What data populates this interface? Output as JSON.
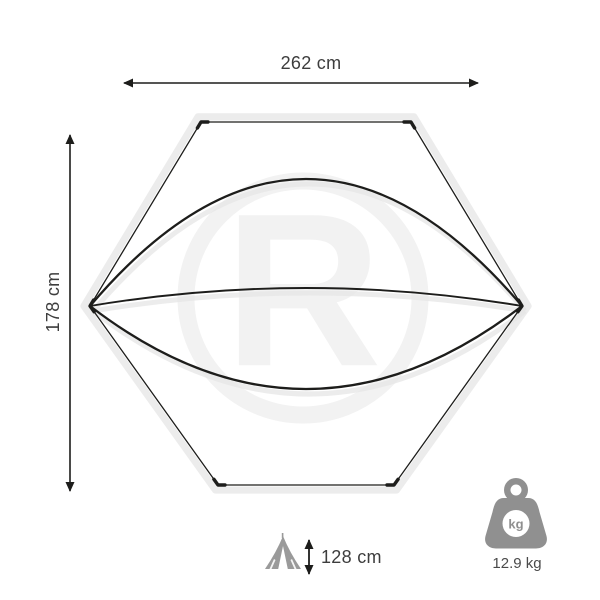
{
  "page": {
    "type": "product-dimension-diagram",
    "subject": "hexagonal tent footprint (top view)"
  },
  "dimensions": {
    "width": {
      "label": "262 cm",
      "orientation": "horizontal-top"
    },
    "depth": {
      "label": "178 cm",
      "orientation": "vertical-left"
    },
    "height": {
      "label": "128 cm",
      "orientation": "bottom-with-tent-icon"
    }
  },
  "weight": {
    "value_label": "12.9 kg",
    "badge": "kg"
  },
  "watermark": {
    "letter": "R"
  },
  "icons": {
    "tent": "tent-icon",
    "weight": "weight-kettlebell-icon",
    "arrows": [
      "width-arrow",
      "depth-arrow",
      "height-arrow"
    ]
  },
  "colors": {
    "line": "#1d1d1b",
    "ghost_outline": "#ececec",
    "curve_shadow": "#e6e6e6",
    "icon_gray": "#909090",
    "label_text": "#3d3d3d",
    "watermark": "#f2f2f2",
    "background": "#ffffff"
  }
}
